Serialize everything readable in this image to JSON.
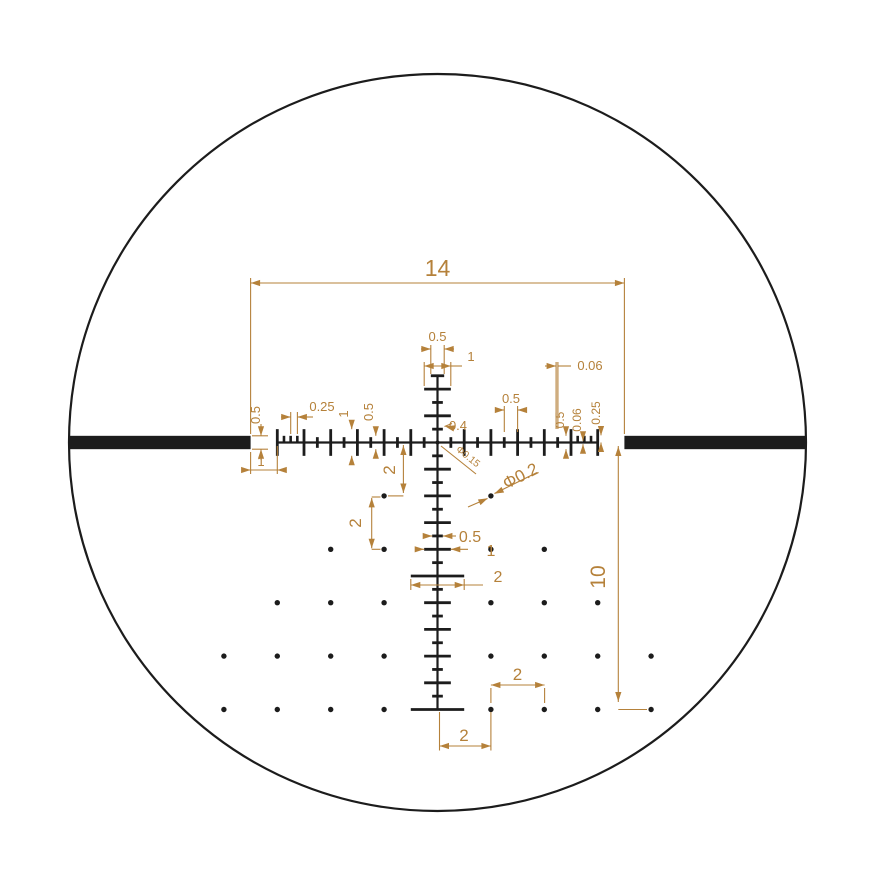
{
  "diagram": {
    "kind": "riflescope-reticle-dimension-drawing",
    "background": "#ffffff",
    "width": 876,
    "height": 876
  },
  "colors": {
    "reticle": "#1c1c1c",
    "annotation": "#b5813a",
    "background": "#ffffff"
  },
  "reticle_spec": {
    "units": "mil",
    "px_per_mil": 26.7,
    "center_px": {
      "x": 437.5,
      "y": 442.5
    },
    "field_circle_radius_px": 368.5,
    "post_thickness": 0.5,
    "post_inner_edge": 7,
    "post_to_line_gap": 1,
    "crosshair_width": 14,
    "drop_extent": 10,
    "line_stroke": 0.06,
    "tall_tick_len": 1,
    "small_tick_len": 0.4,
    "fine_tick_len": 0.25,
    "tick_spacing_small": 0.5,
    "tick_spacing_fine": 0.25,
    "center_dot_dia": 0.15,
    "grid_dot_dia": 0.2,
    "grid_dot_spacing": 2,
    "h_tall_ticks": [
      -6,
      -5,
      -4,
      -3,
      -2,
      -1,
      1,
      2,
      3,
      4,
      5,
      6
    ],
    "h_small_ticks": [
      -4.5,
      -3.5,
      -2.5,
      -1.5,
      -0.5,
      0.5,
      1.5,
      2.5,
      3.5,
      4.5
    ],
    "h_fine_ticks": [
      -5.75,
      -5.5,
      -5.25,
      5.25,
      5.5,
      5.75
    ],
    "v_small_ticks": [
      -1.5,
      -0.5,
      0.5,
      1.5,
      2.5,
      3.5,
      4.5,
      5.5,
      6.5,
      7.5,
      8.5,
      9.5
    ],
    "v_wide_ticks": [
      -2,
      -1,
      1,
      2,
      3,
      4,
      6,
      7,
      8,
      9
    ],
    "v_xwide_ticks": [
      5
    ],
    "v_top_end": {
      "at": -2.5,
      "width": 0.5
    },
    "v_bottom_end": {
      "at": 10,
      "width": 2
    },
    "dots_mil": [
      [
        -2,
        2
      ],
      [
        2,
        2
      ],
      [
        -4,
        4
      ],
      [
        -2,
        4
      ],
      [
        2,
        4
      ],
      [
        4,
        4
      ],
      [
        -6,
        6
      ],
      [
        -4,
        6
      ],
      [
        -2,
        6
      ],
      [
        2,
        6
      ],
      [
        4,
        6
      ],
      [
        6,
        6
      ],
      [
        -8,
        8
      ],
      [
        -6,
        8
      ],
      [
        -4,
        8
      ],
      [
        -2,
        8
      ],
      [
        2,
        8
      ],
      [
        4,
        8
      ],
      [
        6,
        8
      ],
      [
        8,
        8
      ],
      [
        -8,
        10
      ],
      [
        -6,
        10
      ],
      [
        -4,
        10
      ],
      [
        -2,
        10
      ],
      [
        2,
        10
      ],
      [
        4,
        10
      ],
      [
        6,
        10
      ],
      [
        8,
        10
      ]
    ]
  },
  "annotations": {
    "stroke_w": 1.1,
    "labels": [
      {
        "id": "dim-width-14",
        "text": "14",
        "x": 437.5,
        "y": 276,
        "rot": 0,
        "size": 23
      },
      {
        "id": "dim-post-height",
        "text": "0.5",
        "x": 260,
        "y": 415,
        "rot": -90,
        "size": 13
      },
      {
        "id": "dim-post-gap",
        "text": "1",
        "x": 261,
        "y": 466,
        "rot": 0,
        "size": 13
      },
      {
        "id": "dim-quarter-left",
        "text": "0.25",
        "x": 322,
        "y": 411,
        "rot": 0,
        "size": 13
      },
      {
        "id": "dim-one-left",
        "text": "1",
        "x": 348,
        "y": 414,
        "rot": -90,
        "size": 13
      },
      {
        "id": "dim-half-left",
        "text": "0.5",
        "x": 373,
        "y": 412,
        "rot": -90,
        "size": 13
      },
      {
        "id": "dim-top-half",
        "text": "0.5",
        "x": 437.5,
        "y": 341,
        "rot": 0,
        "size": 13
      },
      {
        "id": "dim-top-one",
        "text": "1",
        "x": 471,
        "y": 361,
        "rot": 0,
        "size": 13
      },
      {
        "id": "dim-stroke-top",
        "text": "0.06",
        "x": 590,
        "y": 370,
        "rot": 0,
        "size": 13
      },
      {
        "id": "dim-half-right",
        "text": "0.5",
        "x": 511,
        "y": 403,
        "rot": 0,
        "size": 13
      },
      {
        "id": "dim-half-right-rot",
        "text": "0.5",
        "x": 564,
        "y": 420,
        "rot": -90,
        "size": 12
      },
      {
        "id": "dim-stroke-right-rot",
        "text": "0.06",
        "x": 581,
        "y": 420,
        "rot": -90,
        "size": 12
      },
      {
        "id": "dim-quarter-right-rot",
        "text": "0.25",
        "x": 600,
        "y": 413,
        "rot": -90,
        "size": 12
      },
      {
        "id": "dim-small-tick-04",
        "text": "0.4",
        "x": 458,
        "y": 430,
        "rot": 0,
        "size": 13
      },
      {
        "id": "dim-center-dot",
        "text": "Φ0.15",
        "x": 466,
        "y": 459,
        "rot": 39,
        "size": 10
      },
      {
        "id": "dim-grid-dot",
        "text": "Φ0.2",
        "x": 523,
        "y": 481,
        "rot": -27,
        "size": 17
      },
      {
        "id": "dim-drop-2-first",
        "text": "2",
        "x": 395,
        "y": 470,
        "rot": -90,
        "size": 17
      },
      {
        "id": "dim-drop-2-second",
        "text": "2",
        "x": 361,
        "y": 523,
        "rot": -90,
        "size": 17
      },
      {
        "id": "dim-vtick-half",
        "text": "0.5",
        "x": 470,
        "y": 542,
        "rot": 0,
        "size": 16
      },
      {
        "id": "dim-vtick-one",
        "text": "1",
        "x": 491,
        "y": 556,
        "rot": 0,
        "size": 16
      },
      {
        "id": "dim-vtick-two",
        "text": "2",
        "x": 498,
        "y": 582,
        "rot": 0,
        "size": 16
      },
      {
        "id": "dim-drop-10",
        "text": "10",
        "x": 605,
        "y": 577,
        "rot": -90,
        "size": 21
      },
      {
        "id": "dim-dot-gap-right",
        "text": "2",
        "x": 517.5,
        "y": 680,
        "rot": 0,
        "size": 17
      },
      {
        "id": "dim-dot-gap-bottom",
        "text": "2",
        "x": 464,
        "y": 741,
        "rot": 0,
        "size": 17
      }
    ],
    "lines": [
      [
        250.6,
        283,
        624.4,
        283
      ],
      [
        250.6,
        278,
        250.6,
        434
      ],
      [
        624.4,
        278,
        624.4,
        434
      ],
      [
        252,
        435.8,
        268,
        435.8
      ],
      [
        252,
        449.2,
        268,
        449.2
      ],
      [
        261,
        424,
        261,
        435.8
      ],
      [
        261,
        449.2,
        261,
        460
      ],
      [
        243,
        470,
        285,
        470
      ],
      [
        250.6,
        452,
        250.6,
        474
      ],
      [
        277.3,
        446,
        277.3,
        474
      ],
      [
        290.7,
        412,
        290.7,
        434
      ],
      [
        297.4,
        412,
        297.4,
        434
      ],
      [
        281,
        417,
        290.7,
        417
      ],
      [
        297.4,
        417,
        313,
        417
      ],
      [
        351.7,
        420,
        351.7,
        429.2
      ],
      [
        351.7,
        455.8,
        351.7,
        463
      ],
      [
        375.8,
        427,
        375.8,
        435.8
      ],
      [
        375.8,
        449.2,
        375.8,
        456
      ],
      [
        430.8,
        345,
        430.8,
        374
      ],
      [
        444.2,
        345,
        444.2,
        374
      ],
      [
        421,
        349,
        430.8,
        349
      ],
      [
        444.2,
        349,
        454,
        349
      ],
      [
        424.2,
        362,
        424.2,
        386
      ],
      [
        450.8,
        362,
        450.8,
        386
      ],
      [
        424.2,
        366,
        450.8,
        366
      ],
      [
        450.8,
        366,
        462,
        366
      ],
      [
        556.1,
        362,
        556.1,
        429
      ],
      [
        557.9,
        362,
        557.9,
        429
      ],
      [
        545,
        366,
        556.1,
        366
      ],
      [
        557.9,
        366,
        571,
        366
      ],
      [
        504.3,
        406,
        504.3,
        432
      ],
      [
        517.6,
        406,
        517.6,
        432
      ],
      [
        496,
        410,
        504.3,
        410
      ],
      [
        517.6,
        410,
        526,
        410
      ],
      [
        566,
        428,
        566,
        435.8
      ],
      [
        566,
        449.2,
        566,
        456
      ],
      [
        583,
        433,
        583,
        440.8
      ],
      [
        583,
        444.2,
        583,
        452
      ],
      [
        601,
        427,
        601,
        435.3
      ],
      [
        601,
        442.5,
        601,
        450
      ],
      [
        444.5,
        426.5,
        452,
        423.5
      ],
      [
        441,
        446,
        476,
        474
      ],
      [
        468,
        507,
        487.5,
        498.5
      ],
      [
        494.5,
        493.5,
        537,
        472.5
      ],
      [
        403.4,
        445,
        403.4,
        493
      ],
      [
        403.4,
        495.9,
        388,
        495.9
      ],
      [
        371.7,
        497.9,
        371.7,
        548.3
      ],
      [
        371.7,
        497,
        380.5,
        497
      ],
      [
        371.7,
        549.3,
        380.5,
        549.3
      ],
      [
        425,
        536,
        432.2,
        536
      ],
      [
        442.9,
        536,
        456,
        536
      ],
      [
        417,
        549.3,
        424.2,
        549.3
      ],
      [
        450.8,
        549.3,
        468,
        549.3
      ],
      [
        410.8,
        579,
        410.8,
        590
      ],
      [
        464.2,
        579,
        464.2,
        590
      ],
      [
        410.8,
        585,
        464.2,
        585
      ],
      [
        464.2,
        585,
        483,
        585
      ],
      [
        618.3,
        446,
        618.3,
        702
      ],
      [
        618.3,
        709.5,
        647,
        709.5
      ],
      [
        490.9,
        685,
        544.6,
        685
      ],
      [
        490.9,
        688,
        490.9,
        703
      ],
      [
        544.6,
        688,
        544.6,
        703
      ],
      [
        439.5,
        746,
        490.9,
        746
      ],
      [
        439.5,
        712,
        439.5,
        750.5
      ],
      [
        490.9,
        712,
        490.9,
        750.5
      ]
    ],
    "arrows": [
      [
        250.6,
        283,
        180
      ],
      [
        624.4,
        283,
        0
      ],
      [
        261,
        435.8,
        90
      ],
      [
        261,
        449.2,
        -90
      ],
      [
        250.6,
        470,
        0
      ],
      [
        277.3,
        470,
        180
      ],
      [
        290.7,
        417,
        0
      ],
      [
        297.4,
        417,
        180
      ],
      [
        351.7,
        429.2,
        90
      ],
      [
        351.7,
        455.8,
        -90
      ],
      [
        375.8,
        435.8,
        90
      ],
      [
        375.8,
        449.2,
        -90
      ],
      [
        430.8,
        349,
        0
      ],
      [
        444.2,
        349,
        180
      ],
      [
        424.2,
        366,
        180
      ],
      [
        450.8,
        366,
        0
      ],
      [
        556.1,
        366,
        0
      ],
      [
        504.3,
        410,
        0
      ],
      [
        517.6,
        410,
        180
      ],
      [
        566,
        435.8,
        90
      ],
      [
        566,
        449.2,
        -90
      ],
      [
        583,
        440.8,
        90
      ],
      [
        583,
        444.2,
        -90
      ],
      [
        601,
        435.5,
        90
      ],
      [
        601,
        442.5,
        -90
      ],
      [
        445,
        426.3,
        193
      ],
      [
        487.8,
        498.3,
        -25
      ],
      [
        494.2,
        493.7,
        155
      ],
      [
        403.4,
        445.5,
        -90
      ],
      [
        403.4,
        493,
        90
      ],
      [
        371.7,
        497.9,
        -90
      ],
      [
        371.7,
        548.3,
        90
      ],
      [
        432.2,
        536,
        0
      ],
      [
        442.9,
        536,
        180
      ],
      [
        424.2,
        549.3,
        0
      ],
      [
        450.8,
        549.3,
        180
      ],
      [
        410.8,
        585,
        180
      ],
      [
        464.2,
        585,
        0
      ],
      [
        618.3,
        446.5,
        -90
      ],
      [
        618.3,
        701.5,
        90
      ],
      [
        490.9,
        685,
        180
      ],
      [
        544.6,
        685,
        0
      ],
      [
        439.5,
        746,
        180
      ],
      [
        490.9,
        746,
        0
      ]
    ]
  }
}
